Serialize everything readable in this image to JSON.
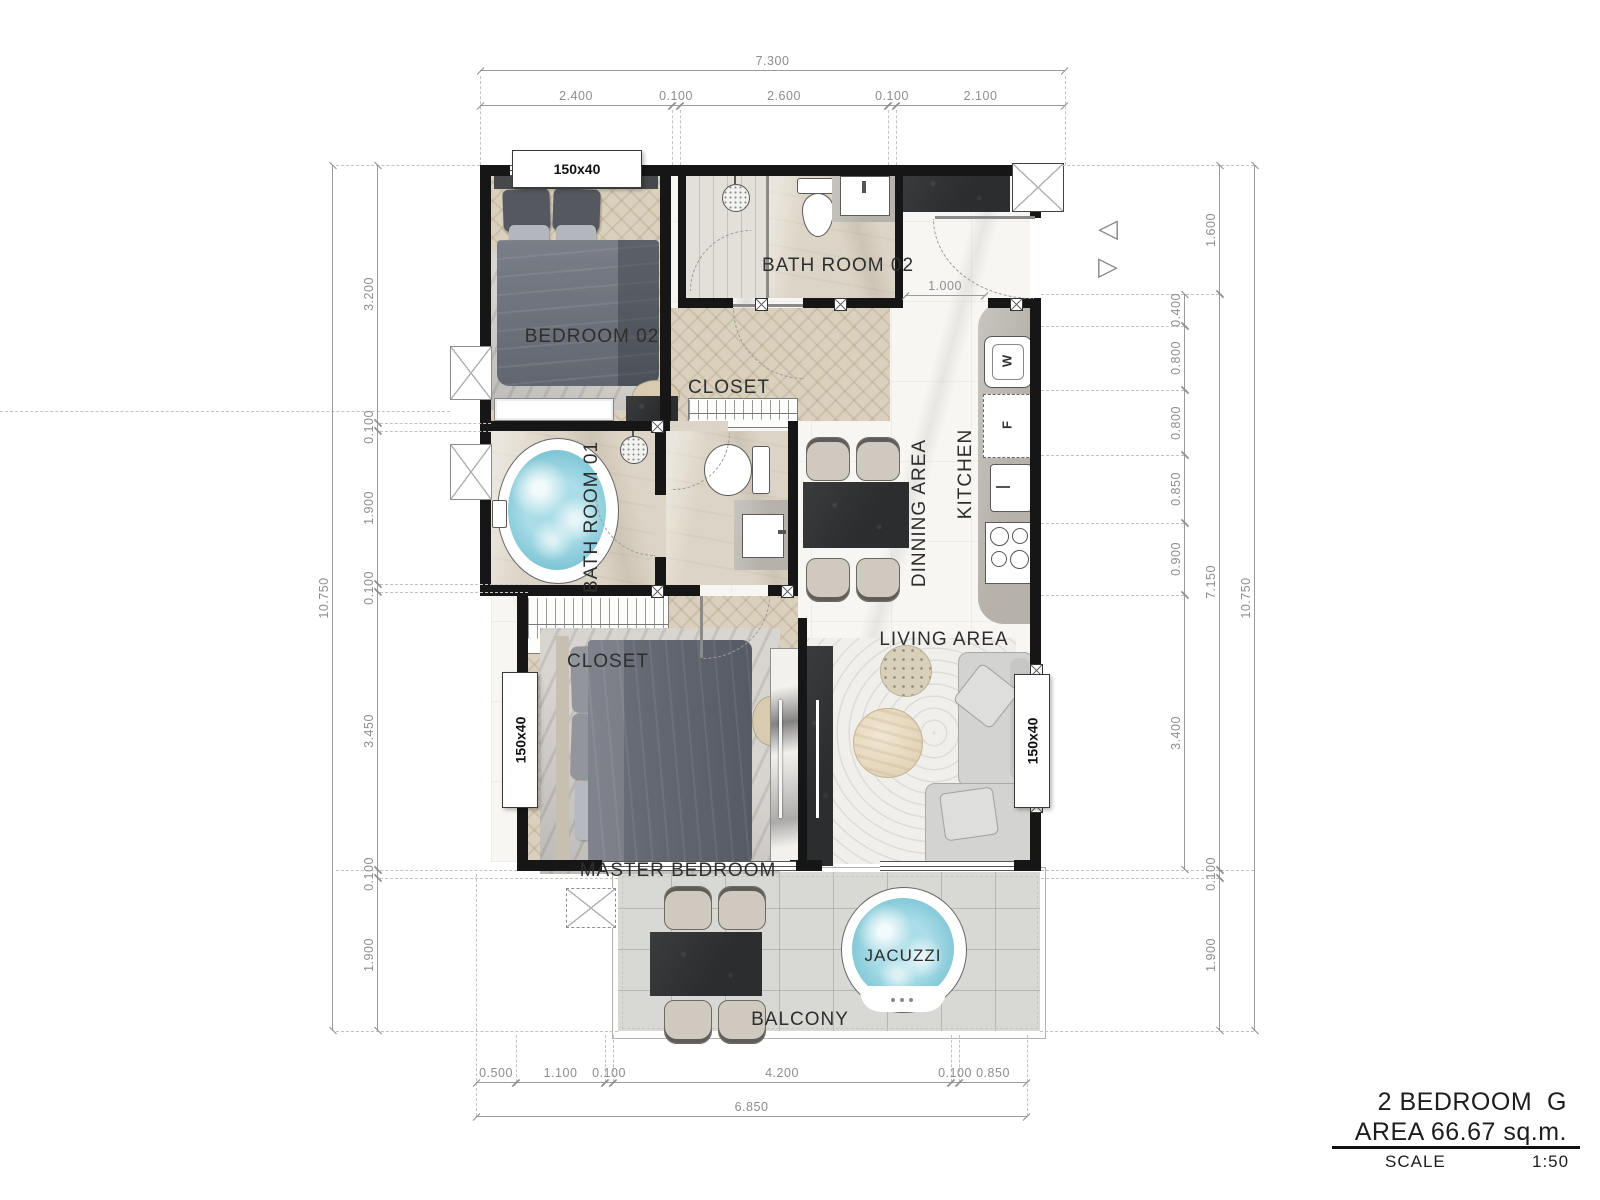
{
  "title_block": {
    "line1": "2 BEDROOM  G",
    "line2": "AREA 66.67 sq.m.",
    "scale_label": "SCALE",
    "scale_value": "1:50"
  },
  "rooms": {
    "bedroom02": "BEDROOM 02",
    "bathroom02": "BATH ROOM 02",
    "closet_top": "CLOSET",
    "bathroom01": "BATH ROOM 01",
    "dining": "DINNING AREA",
    "kitchen": "KITCHEN",
    "living": "LIVING AREA",
    "closet_master": "CLOSET",
    "master_bedroom": "MASTER BEDROOM",
    "balcony": "BALCONY",
    "jacuzzi": "JACUZZI"
  },
  "labels": {
    "window_bedroom02": "150x40",
    "window_master": "150x40",
    "window_living": "150x40",
    "washer": "W",
    "fridge": "F"
  },
  "dimensions": {
    "top": {
      "total": "7.300",
      "segments": [
        "2.400",
        "0.100",
        "2.600",
        "0.100",
        "2.100"
      ]
    },
    "left": {
      "total": "10.750",
      "segments": [
        "3.200",
        "0.100",
        "1.900",
        "0.100",
        "3.450",
        "0.100",
        "1.900"
      ]
    },
    "right": {
      "total": "10.750",
      "outer_segments": [
        "1.600",
        "7.150",
        "0.100",
        "1.900"
      ],
      "inner_segments": [
        "0.400",
        "0.800",
        "0.800",
        "0.850",
        "0.900",
        "3.400"
      ]
    },
    "bottom": {
      "total": "6.850",
      "segments": [
        "0.500",
        "1.100",
        "0.100",
        "4.200",
        "0.100",
        "0.850"
      ]
    },
    "entry": "1.000"
  },
  "colors": {
    "wall": "#161616",
    "dimension_text": "#8d8d8d",
    "water": "#74c0d1",
    "wood_floor": "#d9d0bd",
    "marble_floor": "#f7f6f3",
    "bath_floor": "#dcd4c6",
    "balcony_floor": "#d8d8d5",
    "dark_stone": "#2c2d2f"
  }
}
